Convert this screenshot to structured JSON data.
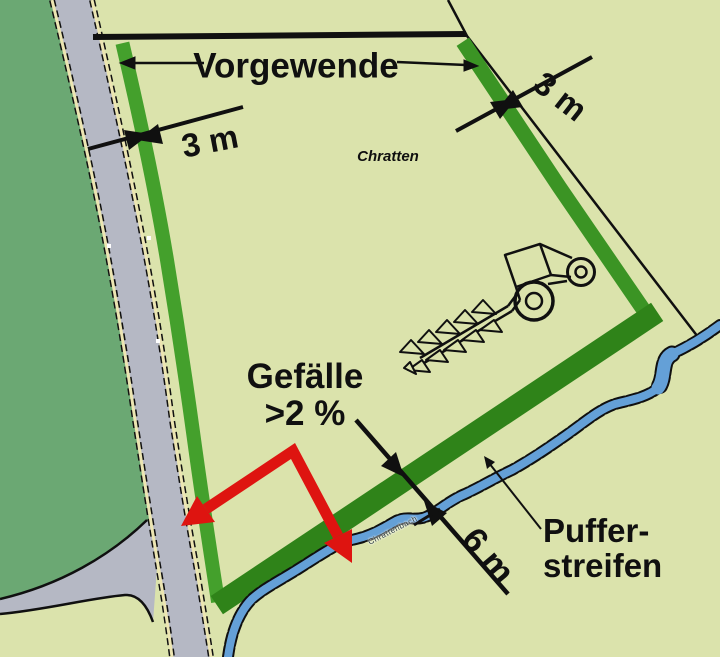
{
  "labels": {
    "vorgewende": "Vorgewende",
    "dim_left": "3 m",
    "dim_right": "3 m",
    "field_name": "Chratten",
    "slope_line1": "Gefälle",
    "slope_line2": ">2 %",
    "dim_buffer": "6 m",
    "buffer_line1": "Puffer-",
    "buffer_line2": "streifen",
    "stream_name": "Chrattenbach"
  },
  "colors": {
    "field": "#dbe3ac",
    "forest": "#6ba873",
    "road": "#b5b8c4",
    "casing": "#ece5b2",
    "strip": "#44a02c",
    "strip2": "#3b9424",
    "strip_dark": "#2f8319",
    "stream": "#64a0d7",
    "arrow_red": "#de1410",
    "ink": "#101010"
  }
}
